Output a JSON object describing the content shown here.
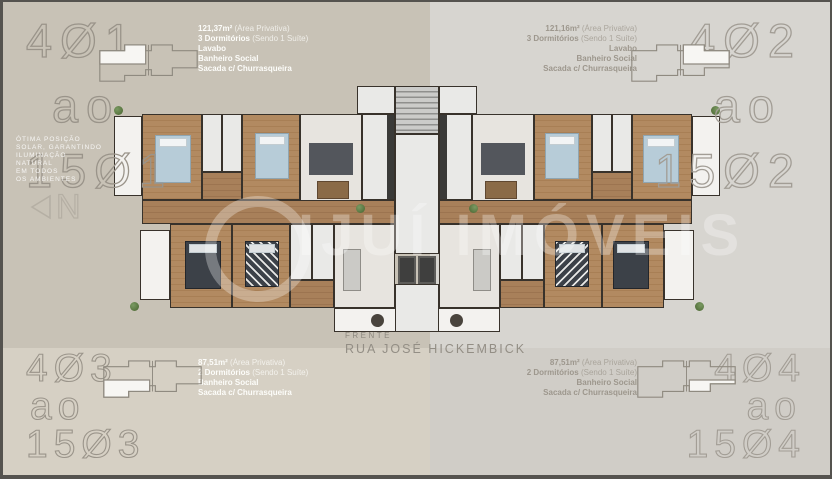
{
  "corner_labels": {
    "tl": [
      "4Ø1",
      "ao",
      "15Ø1"
    ],
    "tr": [
      "4Ø2",
      "ao",
      "15Ø2"
    ],
    "bl": [
      "4Ø3",
      "ao",
      "15Ø3"
    ],
    "br": [
      "4Ø4",
      "ao",
      "15Ø4"
    ]
  },
  "unit_info": {
    "tl": {
      "area": "121,37m²",
      "area_note": "(Área Privativa)",
      "rooms": "3 Dormitórios",
      "rooms_note": "(Sendo 1 Suíte)",
      "f1": "Lavabo",
      "f2": "Banheiro Social",
      "f3": "Sacada c/ Churrasqueira"
    },
    "tr": {
      "area": "121,16m²",
      "area_note": "(Área Privativa)",
      "rooms": "3 Dormitórios",
      "rooms_note": "(Sendo 1 Suíte)",
      "f1": "Lavabo",
      "f2": "Banheiro Social",
      "f3": "Sacada c/ Churrasqueira"
    },
    "bl": {
      "area": "87,51m²",
      "area_note": "(Área Privativa)",
      "rooms": "2 Dormitórios",
      "rooms_note": "(Sendo 1 Suíte)",
      "f1": "Banheiro Social",
      "f2": "Sacada c/ Churrasqueira"
    },
    "br": {
      "area": "87,51m²",
      "area_note": "(Área Privativa)",
      "rooms": "2 Dormitórios",
      "rooms_note": "(Sendo 1 Suíte)",
      "f1": "Banheiro Social",
      "f2": "Sacada c/ Churrasqueira"
    }
  },
  "street": {
    "label": "FRENTE",
    "name": "RUA JOSÉ  HICKEMBICK"
  },
  "side_note": [
    "ÓTIMA POSIÇÃO",
    "SOLAR, GARANTINDO",
    "ILUMINAÇÃO",
    "NATURAL",
    "EM TODOS",
    "OS AMBIENTES"
  ],
  "compass": {
    "letter": "N"
  },
  "watermark": {
    "text": "IJUÍ IMÓVEIS"
  },
  "colors": {
    "bg_top_left": "#c8c2b6",
    "bg_bottom_left": "#d6d0c4",
    "bg_top_right": "#d7d5d0",
    "bg_bottom_right": "#d0cdc7",
    "corner_text": "#9a948a",
    "info_text_left": "#fdfdfa",
    "info_text_right": "#9d978d",
    "wall": "#38322b",
    "wood_floor": "#b28a61",
    "tile_floor": "#e9e9e7",
    "bed_blue": "#b7ccd8",
    "watermark_white": "rgba(255,255,255,0.30)"
  }
}
